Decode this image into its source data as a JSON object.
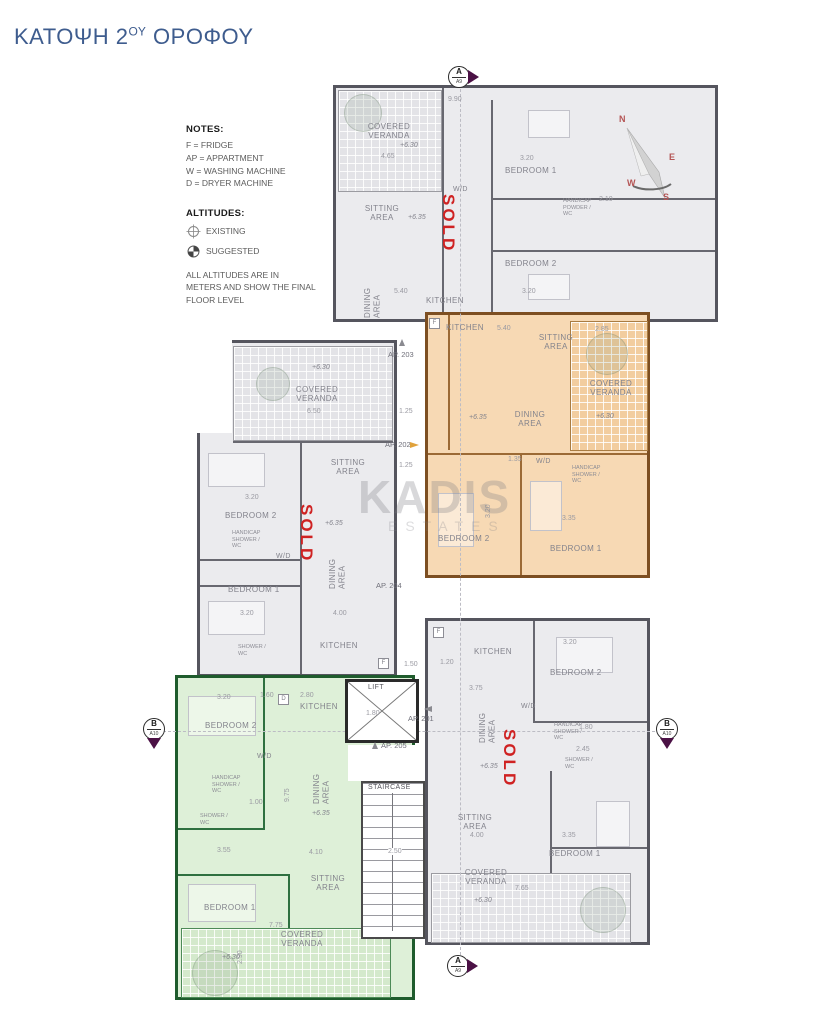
{
  "page": {
    "title_prefix": "ΚΑΤΟΨΗ 2",
    "title_sup": "ΟΥ",
    "title_suffix": " ΟΡΟΦΟΥ"
  },
  "notes": {
    "heading": "NOTES:",
    "lines": [
      "F = FRIDGE",
      "AP = APPARTMENT",
      "W = WASHING MACHINE",
      "D = DRYER MACHINE"
    ],
    "altitudes_heading": "ALTITUDES:",
    "existing": "EXISTING",
    "suggested": "SUGGESTED",
    "footnote": "ALL ALTITUDES ARE IN METERS AND SHOW THE FINAL FLOOR LEVEL"
  },
  "compass": {
    "n": "N",
    "e": "E",
    "w": "W",
    "s": "S"
  },
  "markers": {
    "top": {
      "letter": "A",
      "code": "A9"
    },
    "bottom": {
      "letter": "A",
      "code": "A9"
    },
    "left": {
      "letter": "B",
      "code": "A10"
    },
    "right": {
      "letter": "B",
      "code": "A10"
    }
  },
  "watermark": {
    "name": "KADIS",
    "sub": "ESTATES"
  },
  "core": {
    "lift": "LIFT",
    "lift_dim": "1.80",
    "staircase": "STAIRCASE",
    "staircase_dim": "2.50"
  },
  "sold_label": "SOLD",
  "colors": {
    "title": "#3e5c8e",
    "sold": "#cf2222",
    "orange_fill": "#f7d9b4",
    "green_fill": "#def0d8",
    "grey_fill": "#ebebee",
    "marker_arrow": "#4b1145"
  },
  "ap203": {
    "label": "AP. 203",
    "veranda": "COVERED VERANDA",
    "veranda_alt": "+6.30",
    "veranda_dim": "4.65",
    "top_dim": "9.90",
    "sitting": "SITTING AREA",
    "sitting_alt": "+6.35",
    "dining": "DINING AREA",
    "dining_dim": "5.40",
    "kitchen": "KITCHEN",
    "wd": "W/D",
    "bedroom1": "BEDROOM 1",
    "bedroom1_dim": "3.20",
    "bedroom2": "BEDROOM 2",
    "bedroom2_dim": "3.20",
    "handicap": "HANDICAP POWDER / WC",
    "handicap_dim": "2.10"
  },
  "ap202": {
    "label": "AP. 202",
    "kitchen": "KITCHEN",
    "fridge": "F",
    "kitchen_dim": "5.40",
    "sitting": "SITTING AREA",
    "dining": "DINING AREA",
    "dining_alt": "+6.35",
    "veranda": "COVERED VERANDA",
    "veranda_alt": "+6.30",
    "veranda_dim": "2.85",
    "wd": "W/D",
    "wd_dim": "1.35",
    "bedroom2": "BEDROOM 2",
    "bedroom2_dim": "3.20",
    "bedroom1": "BEDROOM 1",
    "bedroom1_dim": "3.35",
    "handicap": "HANDICAP SHOWER / WC"
  },
  "ap204": {
    "label": "AP. 204",
    "veranda": "COVERED VERANDA",
    "veranda_alt": "+6.30",
    "veranda_dim": "6.50",
    "bedroom2": "BEDROOM 2",
    "bedroom2_dim": "3.20",
    "sitting": "SITTING AREA",
    "sitting_alt": "+6.35",
    "sitting_dim": "4.00",
    "dining": "DINING AREA",
    "bedroom1": "BEDROOM 1",
    "bedroom1_dim": "3.20",
    "wd": "W/D",
    "handicap": "HANDICAP SHOWER / WC",
    "shower": "SHOWER / WC",
    "kitchen": "KITCHEN",
    "kitchen_dim": "1.50",
    "side_dim": "1.25",
    "fridge": "F"
  },
  "ap205": {
    "label": "AP. 205",
    "bedroom2": "BEDROOM 2",
    "bedroom2_dim": "3.20",
    "d_dim": "1.60",
    "dryer": "D",
    "kitchen": "KITCHEN",
    "kitchen_dim": "2.80",
    "wd": "W/D",
    "dining": "DINING AREA",
    "dining_alt": "+6.35",
    "handicap": "HANDICAP SHOWER / WC",
    "handicap_dim": "1.00",
    "shower": "SHOWER / WC",
    "hall_dim": "9.75",
    "bedroom1": "BEDROOM 1",
    "bedroom1_dim": "3.55",
    "sitting": "SITTING AREA",
    "sitting_dim": "4.10",
    "veranda": "COVERED VERANDA",
    "veranda_alt": "+6.30",
    "veranda_dim": "7.75",
    "veranda_h_dim": "2.90"
  },
  "ap201": {
    "label": "AP. 201",
    "fridge": "F",
    "kitchen": "KITCHEN",
    "kitchen_w_dim": "1.20",
    "kitchen_dim": "3.75",
    "bedroom2": "BEDROOM 2",
    "bedroom2_dim": "3.20",
    "wd": "W/D",
    "dining": "DINING AREA",
    "dining_alt": "+6.35",
    "handicap": "HANDICAP SHOWER / WC",
    "handicap_dim": "1.80",
    "shower": "SHOWER / WC",
    "shower_dim": "2.45",
    "sitting": "SITTING AREA",
    "sitting_dim": "4.00",
    "bedroom1": "BEDROOM 1",
    "bedroom1_dim": "3.35",
    "veranda": "COVERED VERANDA",
    "veranda_alt": "+6.30",
    "veranda_dim": "7.65"
  }
}
